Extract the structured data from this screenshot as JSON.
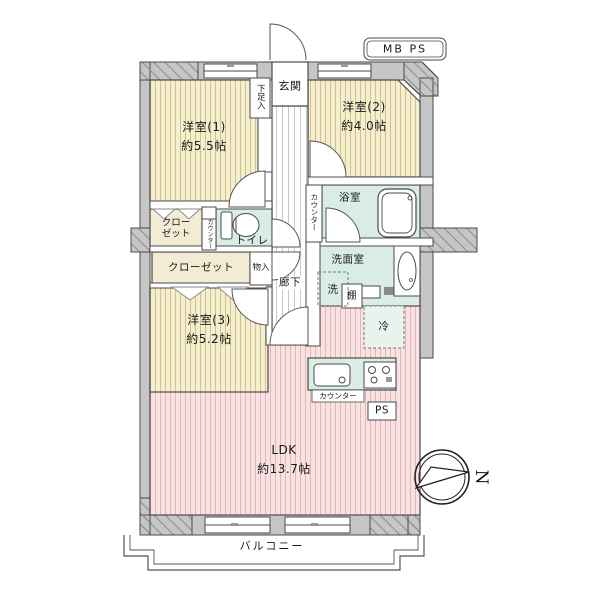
{
  "plan": {
    "utility_top": "MB PS",
    "entrance": "玄関",
    "shoe_cabinet": "下足入",
    "rooms": {
      "room1": {
        "name": "洋室(1)",
        "size": "約5.5帖"
      },
      "room2": {
        "name": "洋室(2)",
        "size": "約4.0帖"
      },
      "room3": {
        "name": "洋室(3)",
        "size": "約5.2帖"
      },
      "ldk": {
        "name": "LDK",
        "size": "約13.7帖"
      },
      "bath": "浴室",
      "washroom": "洗面室",
      "toilet": "トイレ",
      "hallway": "廊下",
      "balcony": "バルコニー"
    },
    "fixtures": {
      "closet_small": "クローゼット",
      "closet_wide": "クローゼット",
      "storage": "物入",
      "washer": "洗",
      "shelf": "棚",
      "fridge": "冷",
      "counter_bath": "カウンター",
      "counter_toilet": "カウンター",
      "counter_kitchen": "カウンター",
      "pipe_space": "PS"
    },
    "compass_north": "N"
  },
  "colors": {
    "wall_gray": "#c6c6c6",
    "room_yellow": "#f6efce",
    "room_yellow_stripe": "#cfc194",
    "ldk_pink": "#f8e3e2",
    "ldk_pink_stripe": "#e2b7b7",
    "wet_teal": "#daece6",
    "closet_beige": "#f3ecd4",
    "line_dark": "#4a4a4a"
  }
}
